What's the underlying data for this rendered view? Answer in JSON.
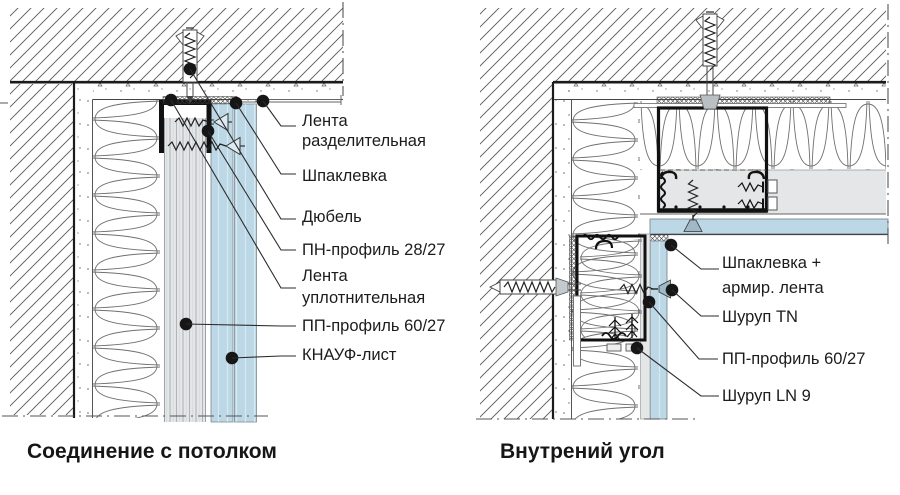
{
  "figure": {
    "type": "technical-drawing",
    "panels": [
      {
        "title": "Соединение с потолком",
        "callouts": [
          {
            "line1": "Лента",
            "line2": "разделительная"
          },
          {
            "line1": "Шпаклевка",
            "line2": ""
          },
          {
            "line1": "Дюбель",
            "line2": ""
          },
          {
            "line1": "ПН-профиль 28/27",
            "line2": ""
          },
          {
            "line1": "Лента",
            "line2": "уплотнительная"
          },
          {
            "line1": "ПП-профиль 60/27",
            "line2": ""
          },
          {
            "line1": "КНАУФ-лист",
            "line2": ""
          }
        ]
      },
      {
        "title": "Внутрений угол",
        "callouts": [
          {
            "line1": "Шпаклевка +",
            "line2": "армир. лента"
          },
          {
            "line1": "Шуруп TN",
            "line2": ""
          },
          {
            "line1": "ПП-профиль 60/27",
            "line2": ""
          },
          {
            "line1": "Шуруп LN 9",
            "line2": ""
          }
        ]
      }
    ],
    "colors": {
      "knauf_sheet_blue": "#bcd8e6",
      "layer_gray": "#e4e6e8",
      "line_black": "#1b1b1b",
      "hatch_gray": "#555555"
    }
  }
}
